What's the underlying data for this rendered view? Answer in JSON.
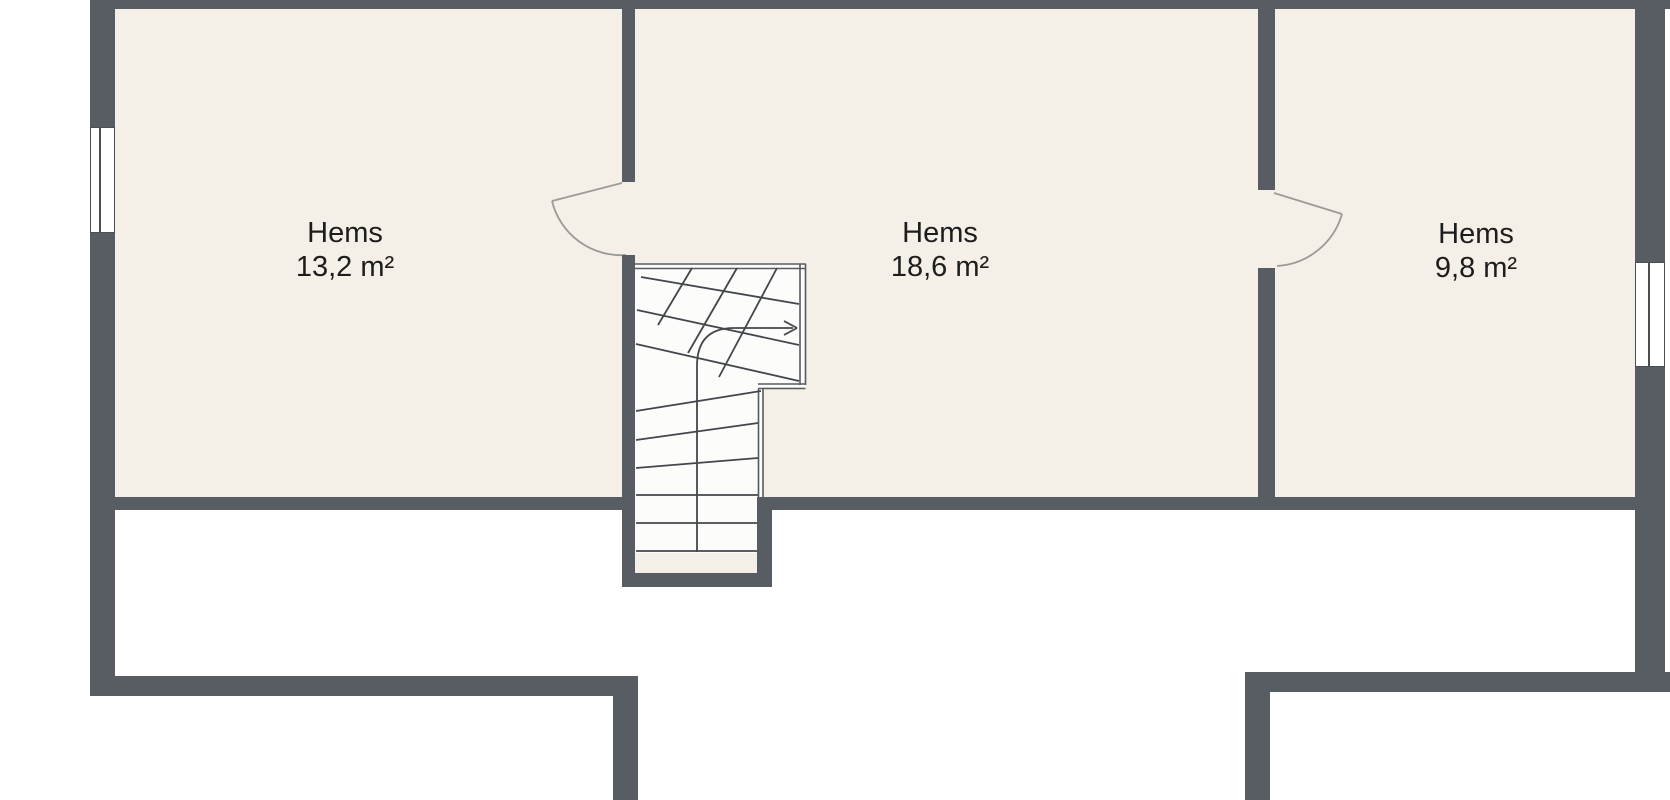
{
  "floorplan": {
    "colors": {
      "wall": "#575d63",
      "floor": "#f4f0e7",
      "stair-floor": "#fcfcfa",
      "line": "#43474d",
      "rail": "#565b61",
      "door": "#9b9b95",
      "text": "#1d1d1d",
      "background": "#ffffff"
    },
    "rooms": [
      {
        "name": "Hems",
        "area": "13,2 m²"
      },
      {
        "name": "Hems",
        "area": "18,6 m²"
      },
      {
        "name": "Hems",
        "area": "9,8 m²"
      }
    ],
    "features": {
      "windows": 2,
      "door_swings": 2,
      "staircase_arrow_direction": "right"
    }
  }
}
